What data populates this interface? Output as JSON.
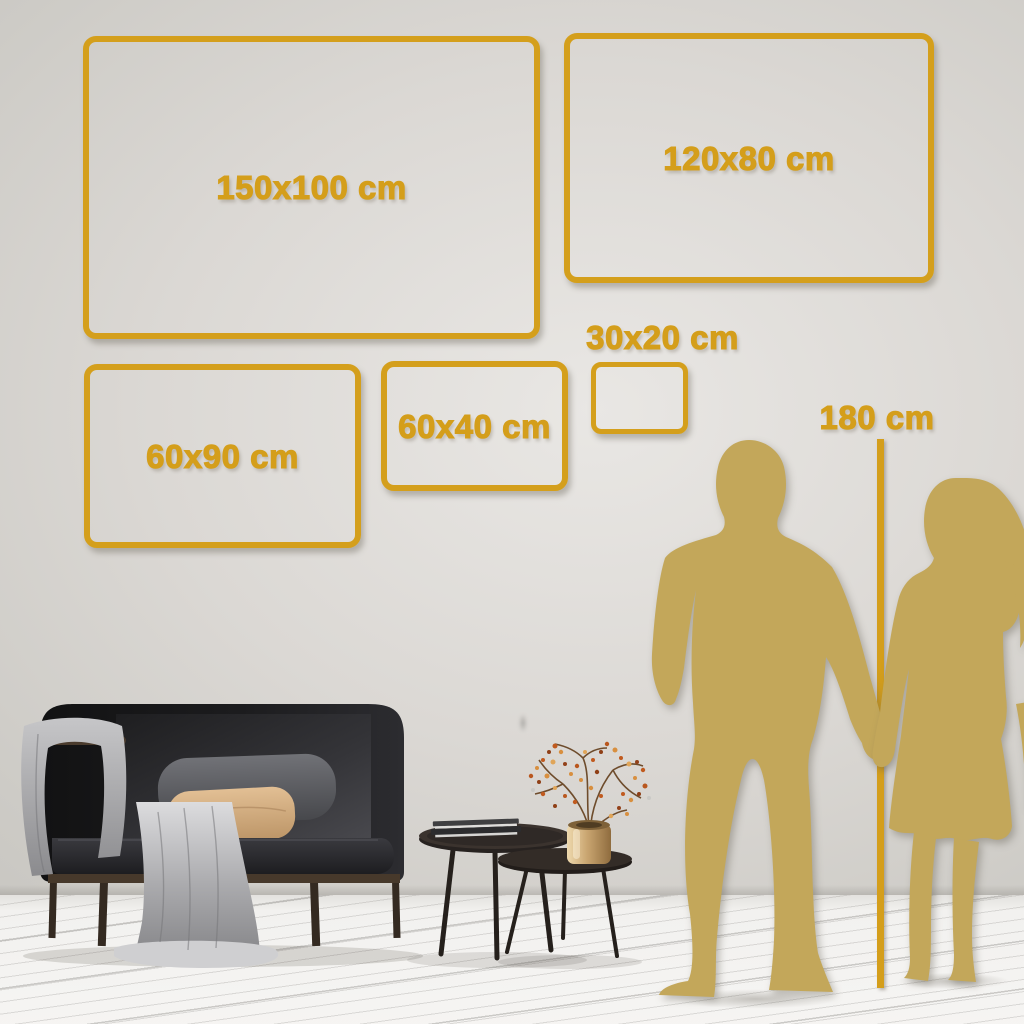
{
  "frames": [
    {
      "id": "150x100",
      "label": "150x100 cm"
    },
    {
      "id": "120x80",
      "label": "120x80 cm"
    },
    {
      "id": "60x90",
      "label": "60x90 cm"
    },
    {
      "id": "60x40",
      "label": "60x40 cm"
    },
    {
      "id": "30x20",
      "label": "30x20 cm"
    }
  ],
  "height_marker": {
    "label": "180 cm"
  },
  "colors": {
    "frame_gold": "#d49f1c",
    "text_gold": "#d49e1b",
    "silhouette_gold": "#c3a75a",
    "wall": "#d8d5d1",
    "floor": "#f2f1ef",
    "sofa_dark": "#1c1c1e",
    "blanket_grey": "#a9a9ac",
    "pillow_beige": "#d4ac7d",
    "vase_brass": "#caa671"
  }
}
